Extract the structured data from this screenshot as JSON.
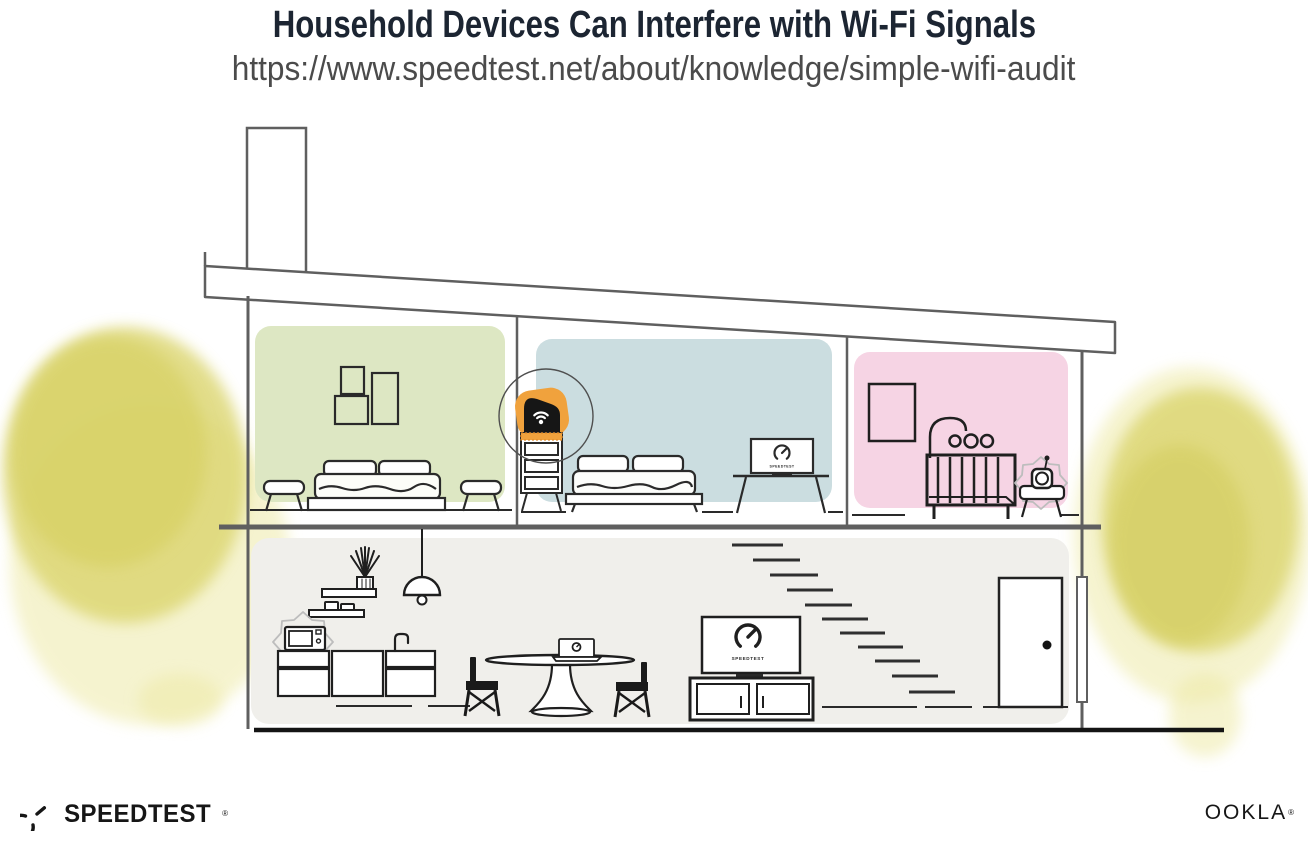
{
  "header": {
    "title": "Household Devices Can Interfere with Wi-Fi Signals",
    "url": "https://www.speedtest.net/about/knowledge/simple-wifi-audit"
  },
  "illustration": {
    "upper_rooms": [
      {
        "id": "bedroom-left",
        "wall_color": "#dde7c3",
        "items": [
          "three-picture-frames",
          "double-bed",
          "two-side-stools"
        ]
      },
      {
        "id": "bedroom-middle",
        "wall_color": "#cbdde0",
        "items": [
          "wifi-router-on-dresser",
          "double-bed",
          "desk-with-speedtest-screen"
        ]
      },
      {
        "id": "nursery",
        "wall_color": "#f6d4e4",
        "items": [
          "picture-frame",
          "baby-mobile",
          "crib",
          "baby-monitor-with-interference",
          "side-stool"
        ]
      }
    ],
    "ground_floor": {
      "id": "kitchen-living-room",
      "wall_color": "#f0efeb",
      "items": [
        "wall-shelves",
        "plant",
        "pendant-lamp",
        "microwave-with-interference",
        "kitchen-cabinets",
        "sink-faucet",
        "dining-table-with-laptop",
        "two-dining-chairs",
        "tv-with-speedtest",
        "tv-console",
        "staircase",
        "front-door",
        "downspout"
      ]
    },
    "interference_devices": [
      "microwave",
      "baby-monitor"
    ],
    "highlighted_device": "wifi-router",
    "screens": {
      "tv_label": "SPEEDTEST",
      "desk_monitor_label": "SPEEDTEST"
    },
    "colors": {
      "router_highlight": "#f0a23d",
      "foliage": "#dbd56e",
      "foliage_light": "#eeeaa8",
      "structure_line": "#5f5f5f",
      "furniture_line": "#1f1f1f",
      "interference_line": "#bdbdbd",
      "title_text": "#1c2532",
      "url_text": "#4b4b4b"
    }
  },
  "footer": {
    "speedtest_wordmark": "SPEEDTEST",
    "ookla_wordmark": "OOKLA",
    "reg_mark": "®"
  }
}
